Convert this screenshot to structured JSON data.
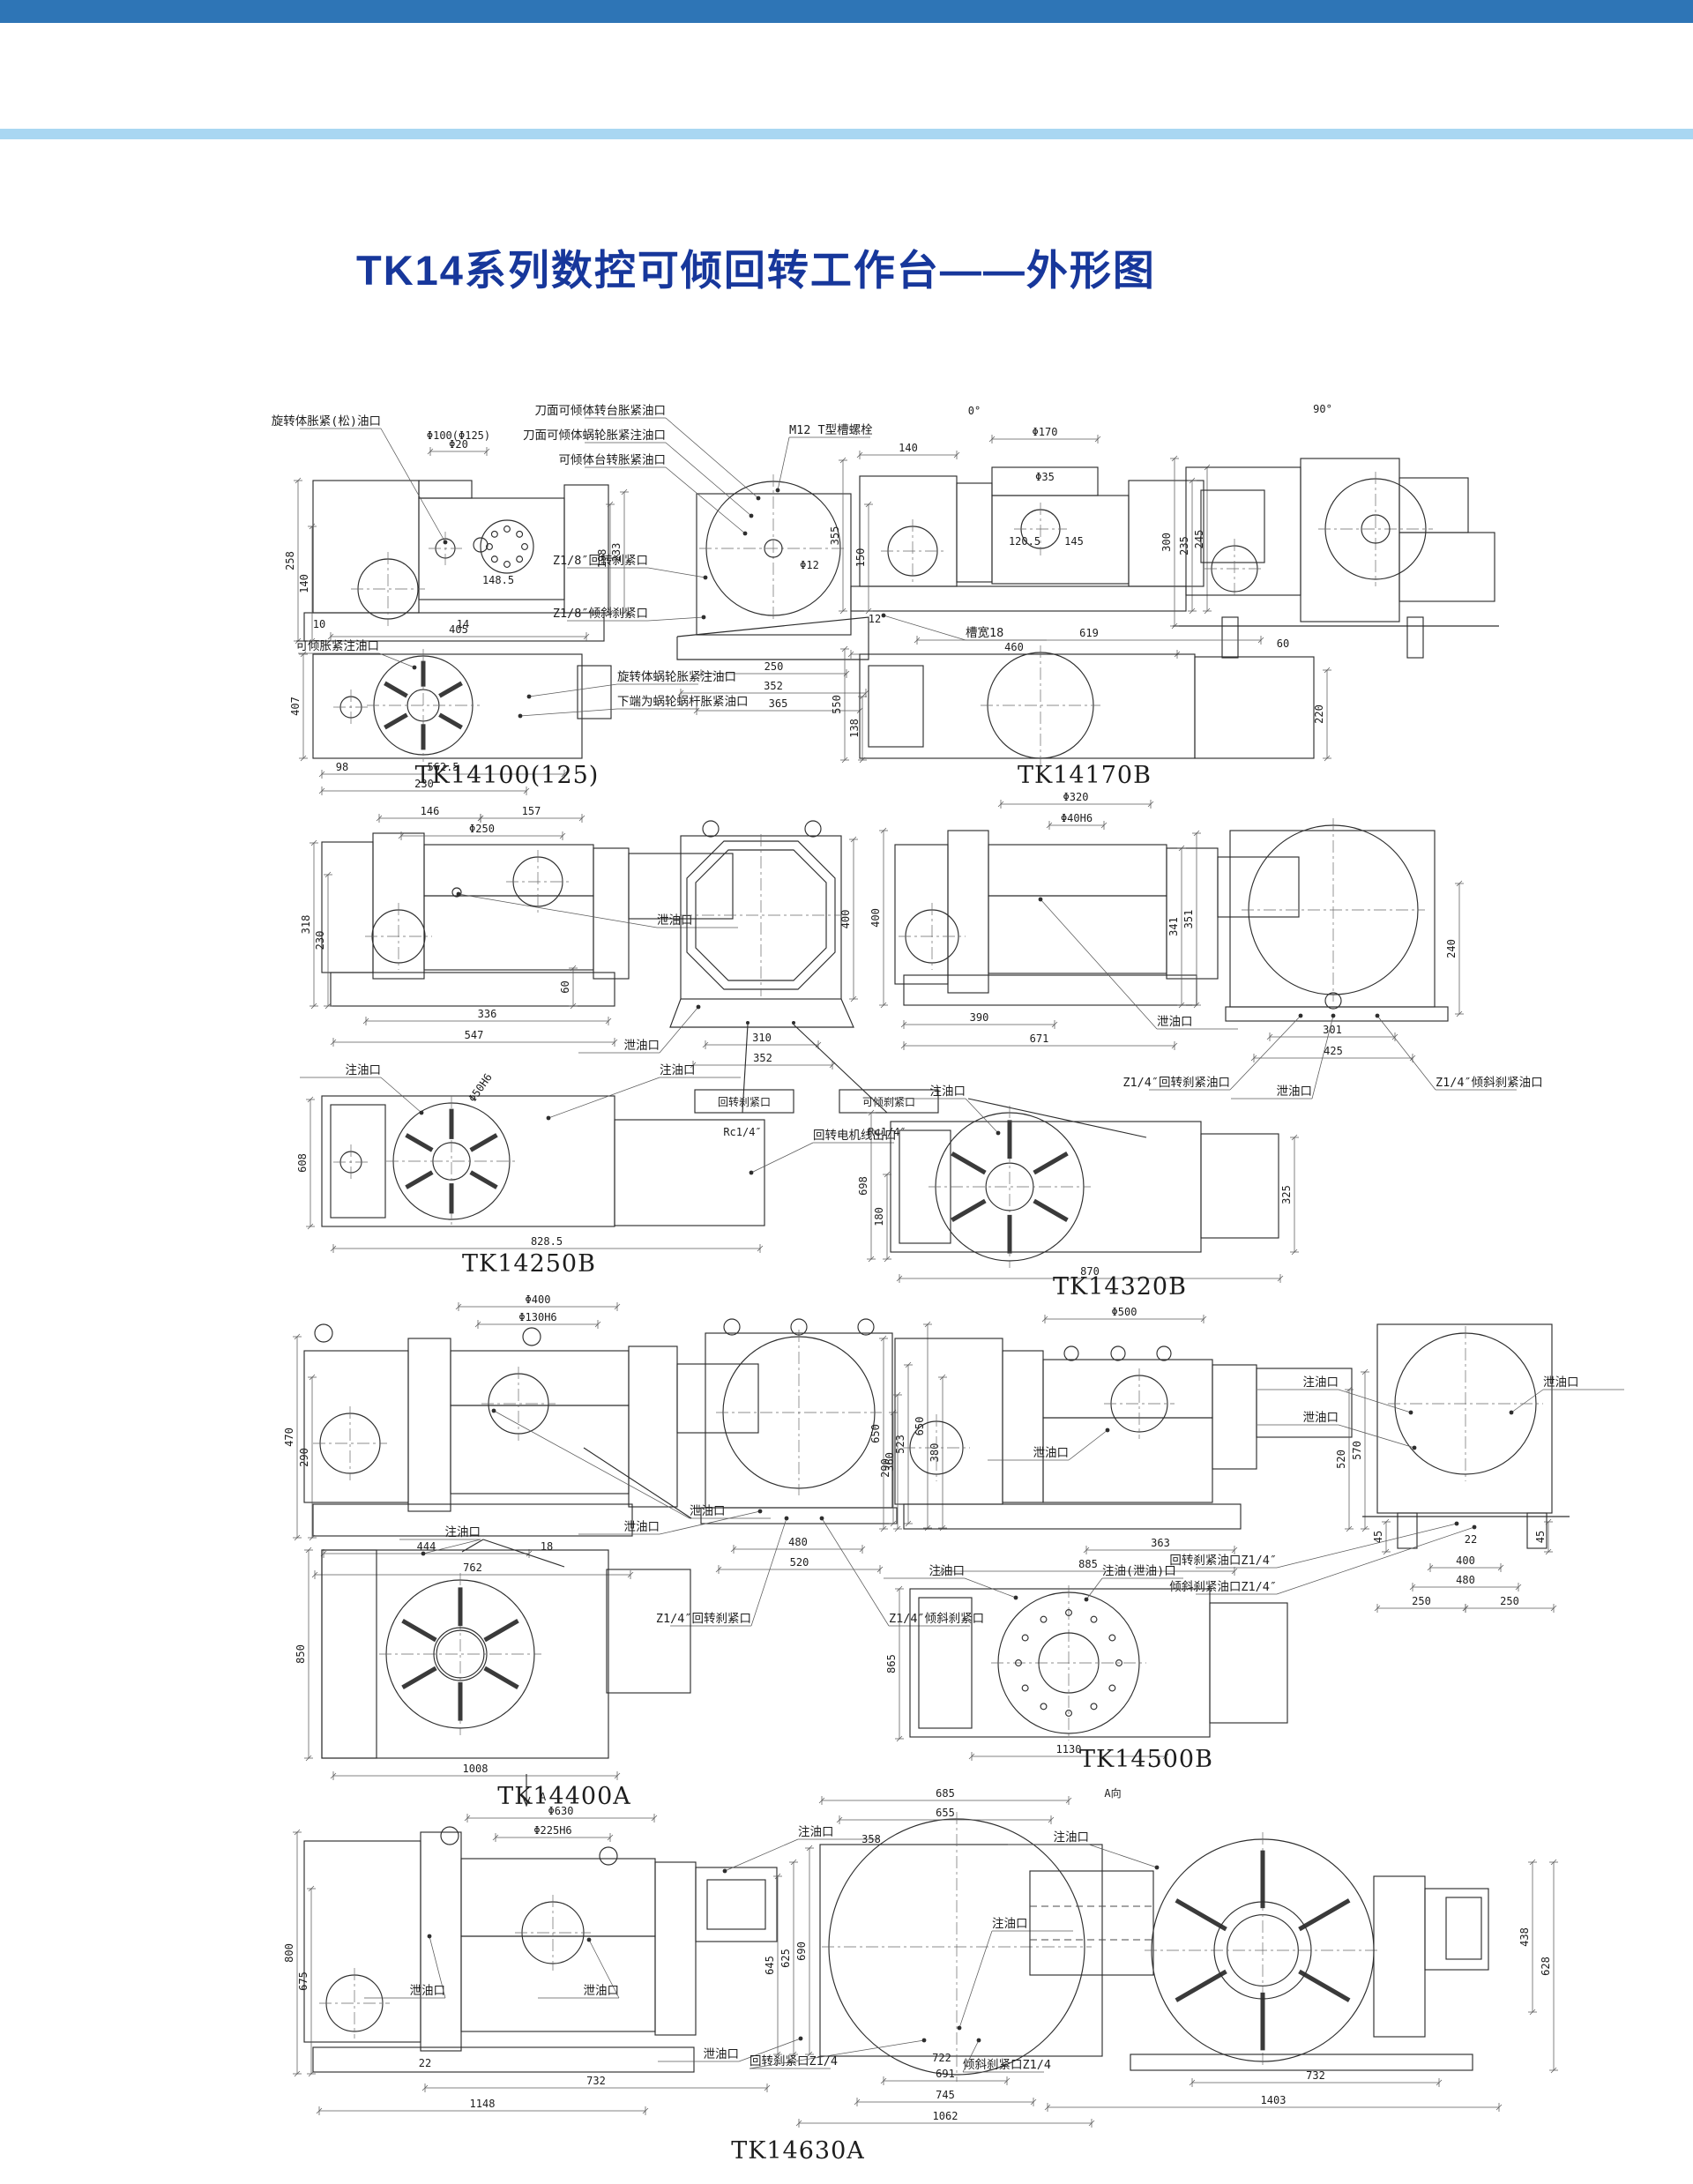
{
  "page": {
    "title": "TK14系列数控可倾回转工作台——外形图",
    "colors": {
      "top_bar": "#2e75b6",
      "rule": "#a9d7f2",
      "title": "#17379b",
      "line": "#2e2e2e"
    }
  },
  "drawings": [
    {
      "label": "TK14100(125)",
      "callouts": [
        "旋转体胀紧(松)油口",
        "刀面可倾体转台胀紧油口",
        "刀面可倾体蜗轮胀紧注油口",
        "可倾体台转胀紧油口",
        "M12 T型槽螺栓",
        "Z1/8″回转刹紧口",
        "Z1/8″倾斜刹紧口",
        "可倾胀紧注油口",
        "旋转体蜗轮胀紧注油口",
        "下端为蜗轮蜗杆胀紧油口"
      ],
      "dims": [
        "Φ100(Φ125)",
        "Φ20",
        "258",
        "140",
        "148.5",
        "198",
        "233",
        "10",
        "405",
        "14",
        "Φ12",
        "250",
        "352",
        "407",
        "98",
        "562.5",
        "230",
        "365"
      ]
    },
    {
      "label": "TK14170B",
      "callouts": [
        "0°",
        "90°",
        "槽宽18"
      ],
      "dims": [
        "140",
        "Φ170",
        "Φ35",
        "355",
        "150",
        "120.5",
        "145",
        "235",
        "245",
        "12",
        "460",
        "300",
        "619",
        "60",
        "550",
        "138",
        "220"
      ]
    },
    {
      "label": "TK14250B",
      "callouts": [
        "泄油口",
        "泄油口",
        "回转刹紧口",
        "可倾刹紧口",
        "Rc1/4″",
        "Rc1/4″",
        "注油口",
        "注油口",
        "回转电机线出口"
      ],
      "dims": [
        "146",
        "157",
        "Φ250",
        "318",
        "230",
        "336",
        "547",
        "60",
        "310",
        "352",
        "400",
        "608",
        "828.5",
        "Φ50H6"
      ]
    },
    {
      "label": "TK14320B",
      "callouts": [
        "泄油口",
        "泄油口",
        "Z1/4″回转刹紧油口",
        "Z1/4″倾斜刹紧油口",
        "注油口"
      ],
      "dims": [
        "Φ320",
        "Φ40H6",
        "400",
        "341",
        "351",
        "390",
        "671",
        "240",
        "301",
        "425",
        "698",
        "180",
        "325",
        "870"
      ]
    },
    {
      "label": "TK14400A",
      "callouts": [
        "泄油口",
        "泄油口",
        "注油口",
        "Z1/4″回转刹紧口",
        "Z1/4″倾斜刹紧口"
      ],
      "dims": [
        "Φ400",
        "Φ130H6",
        "470",
        "290",
        "444",
        "18",
        "762",
        "523",
        "290",
        "650",
        "380",
        "480",
        "520",
        "850",
        "1008"
      ]
    },
    {
      "label": "TK14500B",
      "callouts": [
        "注油口",
        "泄油口",
        "泄油口",
        "泄油口",
        "回转刹紧油口Z1/4″",
        "倾斜刹紧油口Z1/4″",
        "注油口",
        "注油(泄油)口"
      ],
      "dims": [
        "Φ500",
        "650",
        "360",
        "570",
        "520",
        "363",
        "885",
        "45",
        "45",
        "22",
        "400",
        "480",
        "250",
        "250",
        "1130",
        "865"
      ]
    },
    {
      "label": "TK14630A",
      "callouts": [
        "A",
        "A向",
        "注油口",
        "泄油口",
        "泄油口",
        "注油口",
        "泄油口",
        "回转刹紧口Z1/4",
        "倾斜刹紧口Z1/4",
        "注油口"
      ],
      "dims": [
        "Φ630",
        "Φ225H6",
        "800",
        "675",
        "645",
        "625",
        "690",
        "22",
        "732",
        "1148",
        "685",
        "655",
        "358",
        "722",
        "691",
        "745",
        "1062",
        "732",
        "1403",
        "438",
        "628"
      ]
    }
  ]
}
